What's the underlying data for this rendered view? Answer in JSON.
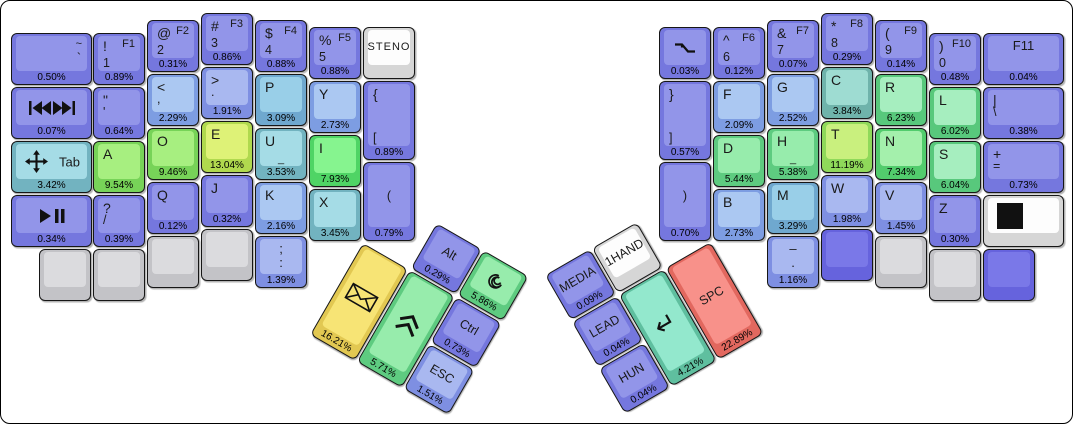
{
  "canvas": {
    "width": 1073,
    "height": 424,
    "background": "#ffffff",
    "border_color": "#000000"
  },
  "palette": {
    "purple": {
      "base": "#7577de",
      "top": "#9295e9"
    },
    "blue1": {
      "base": "#7e8fe2",
      "top": "#a9b8f0"
    },
    "blue2": {
      "base": "#7d9de2",
      "top": "#abc8f2"
    },
    "cyan1": {
      "base": "#6fa8cf",
      "top": "#99cfe8"
    },
    "cyan2": {
      "base": "#72b3c0",
      "top": "#a5dce6"
    },
    "tealC": {
      "base": "#6fb3ab",
      "top": "#9edcd2"
    },
    "tealE": {
      "base": "#5fbf9f",
      "top": "#93e8cd"
    },
    "mint": {
      "base": "#5ecb80",
      "top": "#97ecac"
    },
    "green1": {
      "base": "#58c87c",
      "top": "#a6eebf"
    },
    "greenN": {
      "base": "#52cc6d",
      "top": "#a4f0ac"
    },
    "greenI": {
      "base": "#4fd465",
      "top": "#86f48f"
    },
    "greenAO": {
      "base": "#77d358",
      "top": "#a7ef80"
    },
    "ygT": {
      "base": "#8fd95a",
      "top": "#c9f07e"
    },
    "ygE": {
      "base": "#b0d94e",
      "top": "#def277"
    },
    "yellow": {
      "base": "#e2c852",
      "top": "#f7e475"
    },
    "red": {
      "base": "#e2685f",
      "top": "#f8918a"
    },
    "gray": {
      "base": "#c3c3c7",
      "top": "#dbdbde"
    },
    "white": {
      "base": "#d6d6d6",
      "top": "#fdfdfd"
    },
    "flatpurple": {
      "base": "#6663dd",
      "top": "#7a78e8"
    }
  },
  "fixed_keys": [
    {
      "id": "tilde",
      "x": 10,
      "y": 32,
      "w": 81,
      "color": "purple",
      "labels": {
        "tr": "~",
        "mr": "`"
      },
      "pct": "0.50%"
    },
    {
      "id": "num1",
      "x": 92,
      "y": 32,
      "color": "purple",
      "labels": {
        "tl": "!",
        "tr": "F1",
        "bl": "1"
      },
      "pct": "0.89%"
    },
    {
      "id": "num2",
      "x": 146,
      "y": 19,
      "color": "purple",
      "labels": {
        "tl": "@",
        "tr": "F2",
        "bl": "2"
      },
      "pct": "0.31%"
    },
    {
      "id": "num3",
      "x": 200,
      "y": 12,
      "color": "purple",
      "labels": {
        "tl": "#",
        "tr": "F3",
        "bl": "3"
      },
      "pct": "0.86%"
    },
    {
      "id": "num4",
      "x": 254,
      "y": 19,
      "color": "purple",
      "labels": {
        "tl": "$",
        "tr": "F4",
        "bl": "4"
      },
      "pct": "0.88%"
    },
    {
      "id": "num5",
      "x": 308,
      "y": 26,
      "color": "purple",
      "labels": {
        "tl": "%",
        "tr": "F5",
        "bl": "5"
      },
      "pct": "0.88%"
    },
    {
      "id": "steno",
      "x": 362,
      "y": 26,
      "color": "white",
      "cls": "steno",
      "labels": {
        "c": "STENO"
      }
    },
    {
      "id": "skip-track",
      "x": 10,
      "y": 86,
      "w": 81,
      "color": "purple",
      "icon": "skip-track",
      "pct": "0.07%"
    },
    {
      "id": "quote",
      "x": 92,
      "y": 86,
      "color": "purple",
      "labels": {
        "tl": "\"",
        "ml": "'"
      },
      "pct": "0.64%"
    },
    {
      "id": "comma",
      "x": 146,
      "y": 73,
      "color": "blue2",
      "labels": {
        "tl": "<",
        "ml": ","
      },
      "pct": "2.29%"
    },
    {
      "id": "period",
      "x": 200,
      "y": 66,
      "color": "blue1",
      "labels": {
        "tl": ">",
        "ml": "."
      },
      "pct": "1.91%"
    },
    {
      "id": "p",
      "x": 254,
      "y": 73,
      "color": "cyan1",
      "labels": {
        "tl": "P"
      },
      "pct": "3.09%"
    },
    {
      "id": "y",
      "x": 308,
      "y": 80,
      "color": "blue2",
      "labels": {
        "tl": "Y"
      },
      "pct": "2.73%"
    },
    {
      "id": "lbrace",
      "x": 362,
      "y": 80,
      "h": 79,
      "color": "purple",
      "labels": {
        "tl": "{",
        "bl": "["
      },
      "pct": "0.89%"
    },
    {
      "id": "tab",
      "x": 10,
      "y": 140,
      "w": 81,
      "color": "cyan2",
      "icon": "move",
      "icon_align": "left",
      "labels": {
        "cr": "Tab"
      },
      "pct": "3.42%"
    },
    {
      "id": "a",
      "x": 92,
      "y": 140,
      "color": "greenAO",
      "labels": {
        "tl": "A"
      },
      "pct": "9.54%"
    },
    {
      "id": "o",
      "x": 146,
      "y": 127,
      "color": "greenAO",
      "labels": {
        "tl": "O"
      },
      "pct": "9.46%"
    },
    {
      "id": "e",
      "x": 200,
      "y": 120,
      "color": "ygE",
      "labels": {
        "tl": "E"
      },
      "pct": "13.04%"
    },
    {
      "id": "u",
      "x": 254,
      "y": 127,
      "color": "cyan2",
      "labels": {
        "tl": "U",
        "bc": "_"
      },
      "pct": "3.53%"
    },
    {
      "id": "i",
      "x": 308,
      "y": 134,
      "color": "greenI",
      "labels": {
        "tl": "I"
      },
      "pct": "7.93%"
    },
    {
      "id": "lparen",
      "x": 362,
      "y": 161,
      "h": 79,
      "color": "purple",
      "labels": {
        "c": "("
      },
      "pct": "0.79%"
    },
    {
      "id": "play-pause",
      "x": 10,
      "y": 194,
      "w": 81,
      "color": "purple",
      "icon": "play-pause",
      "pct": "0.34%"
    },
    {
      "id": "slash",
      "x": 92,
      "y": 194,
      "color": "purple",
      "labels": {
        "tl": "?",
        "ml": "/"
      },
      "pct": "0.39%"
    },
    {
      "id": "q",
      "x": 146,
      "y": 181,
      "color": "purple",
      "labels": {
        "tl": "Q"
      },
      "pct": "0.12%"
    },
    {
      "id": "j",
      "x": 200,
      "y": 174,
      "color": "purple",
      "labels": {
        "tl": "J"
      },
      "pct": "0.32%"
    },
    {
      "id": "k",
      "x": 254,
      "y": 181,
      "color": "blue2",
      "labels": {
        "tl": "K"
      },
      "pct": "2.16%"
    },
    {
      "id": "x",
      "x": 308,
      "y": 188,
      "color": "cyan2",
      "labels": {
        "tl": "X"
      },
      "pct": "3.45%"
    },
    {
      "id": "blank-l1",
      "x": 38,
      "y": 248,
      "color": "gray"
    },
    {
      "id": "blank-l2",
      "x": 92,
      "y": 248,
      "color": "gray"
    },
    {
      "id": "blank-l3",
      "x": 146,
      "y": 235,
      "color": "gray"
    },
    {
      "id": "blank-l4",
      "x": 200,
      "y": 228,
      "color": "gray"
    },
    {
      "id": "semicolon",
      "x": 254,
      "y": 235,
      "color": "blue1",
      "labels": {
        "tc": ";",
        "mc": ":"
      },
      "pct": "1.39%"
    },
    {
      "id": "falling-edge",
      "x": 658,
      "y": 26,
      "color": "purple",
      "icon": "falling-edge",
      "pct": "0.03%"
    },
    {
      "id": "num6",
      "x": 712,
      "y": 26,
      "color": "purple",
      "labels": {
        "tl": "^",
        "tr": "F6",
        "bl": "6"
      },
      "pct": "0.12%"
    },
    {
      "id": "num7",
      "x": 766,
      "y": 19,
      "color": "purple",
      "labels": {
        "tl": "&",
        "tr": "F7",
        "bl": "7"
      },
      "pct": "0.07%"
    },
    {
      "id": "num8",
      "x": 820,
      "y": 12,
      "color": "purple",
      "labels": {
        "tl": "*",
        "tr": "F8",
        "bl": "8"
      },
      "pct": "0.29%"
    },
    {
      "id": "num9",
      "x": 874,
      "y": 19,
      "color": "purple",
      "labels": {
        "tl": "(",
        "tr": "F9",
        "bl": "9"
      },
      "pct": "0.14%"
    },
    {
      "id": "num0",
      "x": 928,
      "y": 32,
      "color": "purple",
      "labels": {
        "tl": ")",
        "tr": "F10",
        "bl": "0"
      },
      "pct": "0.48%"
    },
    {
      "id": "f11",
      "x": 982,
      "y": 32,
      "w": 81,
      "color": "purple",
      "labels": {
        "tc": "F11"
      },
      "pct": "0.04%"
    },
    {
      "id": "rbrace",
      "x": 658,
      "y": 80,
      "h": 79,
      "color": "purple",
      "labels": {
        "tl": "}",
        "bl": "]"
      },
      "pct": "0.57%"
    },
    {
      "id": "f",
      "x": 712,
      "y": 80,
      "color": "blue2",
      "labels": {
        "tl": "F"
      },
      "pct": "2.09%"
    },
    {
      "id": "g",
      "x": 766,
      "y": 73,
      "color": "blue2",
      "labels": {
        "tl": "G"
      },
      "pct": "2.52%"
    },
    {
      "id": "c",
      "x": 820,
      "y": 66,
      "color": "tealC",
      "labels": {
        "tl": "C"
      },
      "pct": "3.84%"
    },
    {
      "id": "r",
      "x": 874,
      "y": 73,
      "color": "green1",
      "labels": {
        "tl": "R"
      },
      "pct": "6.23%"
    },
    {
      "id": "l",
      "x": 928,
      "y": 86,
      "color": "green1",
      "labels": {
        "tl": "L"
      },
      "pct": "6.02%"
    },
    {
      "id": "pipe",
      "x": 982,
      "y": 86,
      "w": 81,
      "color": "purple",
      "labels": {
        "tl": "|",
        "ml": "\\"
      },
      "pct": "0.38%"
    },
    {
      "id": "rparen",
      "x": 658,
      "y": 161,
      "h": 79,
      "color": "purple",
      "labels": {
        "c": ")"
      },
      "pct": "0.70%"
    },
    {
      "id": "d",
      "x": 712,
      "y": 134,
      "color": "mint",
      "labels": {
        "tl": "D"
      },
      "pct": "5.44%"
    },
    {
      "id": "h",
      "x": 766,
      "y": 127,
      "color": "mint",
      "labels": {
        "tl": "H",
        "bc": "_"
      },
      "pct": "5.38%"
    },
    {
      "id": "t",
      "x": 820,
      "y": 120,
      "color": "ygT",
      "labels": {
        "tl": "T"
      },
      "pct": "11.19%"
    },
    {
      "id": "n",
      "x": 874,
      "y": 127,
      "color": "greenN",
      "labels": {
        "tl": "N"
      },
      "pct": "7.34%"
    },
    {
      "id": "s",
      "x": 928,
      "y": 140,
      "color": "green1",
      "labels": {
        "tl": "S"
      },
      "pct": "6.04%"
    },
    {
      "id": "plus",
      "x": 982,
      "y": 140,
      "w": 81,
      "color": "purple",
      "labels": {
        "tl": "+",
        "ml": "="
      },
      "pct": "0.73%"
    },
    {
      "id": "b",
      "x": 712,
      "y": 188,
      "color": "blue2",
      "labels": {
        "tl": "B"
      },
      "pct": "2.73%"
    },
    {
      "id": "m",
      "x": 766,
      "y": 181,
      "color": "cyan1",
      "labels": {
        "tl": "M"
      },
      "pct": "3.29%"
    },
    {
      "id": "w",
      "x": 820,
      "y": 174,
      "color": "blue1",
      "labels": {
        "tl": "W"
      },
      "pct": "1.98%"
    },
    {
      "id": "v",
      "x": 874,
      "y": 181,
      "color": "blue1",
      "labels": {
        "tl": "V"
      },
      "pct": "1.45%"
    },
    {
      "id": "z",
      "x": 928,
      "y": 194,
      "color": "purple",
      "labels": {
        "tl": "Z"
      },
      "pct": "0.30%"
    },
    {
      "id": "stop-square",
      "x": 982,
      "y": 194,
      "w": 81,
      "color": "white",
      "icon": "black-square",
      "icon_align": "left"
    },
    {
      "id": "dash",
      "x": 766,
      "y": 235,
      "color": "blue1",
      "labels": {
        "tc": "–",
        "mc": "."
      },
      "pct": "1.16%"
    },
    {
      "id": "blank-r1",
      "x": 820,
      "y": 228,
      "color": "flatpurple"
    },
    {
      "id": "blank-r2",
      "x": 874,
      "y": 235,
      "color": "gray"
    },
    {
      "id": "blank-r3",
      "x": 928,
      "y": 248,
      "color": "gray"
    },
    {
      "id": "blank-r4",
      "x": 982,
      "y": 248,
      "color": "flatpurple"
    }
  ],
  "thumb_clusters": [
    {
      "id": "left-thumb",
      "x": 362,
      "y": 242,
      "rotation_deg": 30,
      "keys": [
        {
          "id": "envelope",
          "x": 0,
          "y": 0,
          "w": 52,
          "h": 106,
          "color": "yellow",
          "icon": "envelope",
          "pct": "16.21%"
        },
        {
          "id": "shift",
          "x": 54,
          "y": 0,
          "w": 52,
          "h": 106,
          "color": "mint",
          "icon": "shift-chevrons",
          "pct": "5.71%"
        },
        {
          "id": "alt",
          "x": 54,
          "y": -54,
          "color": "purple",
          "labels": {
            "c": "Alt"
          },
          "pct": "0.29%"
        },
        {
          "id": "spiral",
          "x": 108,
          "y": -54,
          "color": "mint",
          "icon": "spiral",
          "pct": "5.86%"
        },
        {
          "id": "ctrl",
          "x": 108,
          "y": 0,
          "color": "purple",
          "labels": {
            "c": "Ctrl"
          },
          "pct": "0.73%"
        },
        {
          "id": "esc",
          "x": 108,
          "y": 54,
          "color": "blue1",
          "labels": {
            "c": "ESC"
          },
          "pct": "1.51%"
        }
      ]
    },
    {
      "id": "right-thumb",
      "x": 571,
      "y": 321,
      "rotation_deg": -30,
      "keys": [
        {
          "id": "media",
          "x": 0,
          "y": -54,
          "color": "purple",
          "labels": {
            "c": "MEDIA"
          },
          "pct": "0.09%"
        },
        {
          "id": "onehand",
          "x": 54,
          "y": -54,
          "color": "white",
          "labels": {
            "c": "1HAND"
          }
        },
        {
          "id": "lead",
          "x": 0,
          "y": 0,
          "color": "purple",
          "labels": {
            "c": "LEAD"
          },
          "pct": "0.04%"
        },
        {
          "id": "hun",
          "x": 0,
          "y": 54,
          "color": "purple",
          "labels": {
            "c": "HUN"
          },
          "pct": "0.04%"
        },
        {
          "id": "enter",
          "x": 54,
          "y": 0,
          "w": 52,
          "h": 106,
          "color": "tealE",
          "icon": "enter-return",
          "pct": "4.21%"
        },
        {
          "id": "spc",
          "x": 108,
          "y": 0,
          "w": 52,
          "h": 106,
          "color": "red",
          "labels": {
            "c": "SPC"
          },
          "pct": "22.89%"
        }
      ]
    }
  ]
}
